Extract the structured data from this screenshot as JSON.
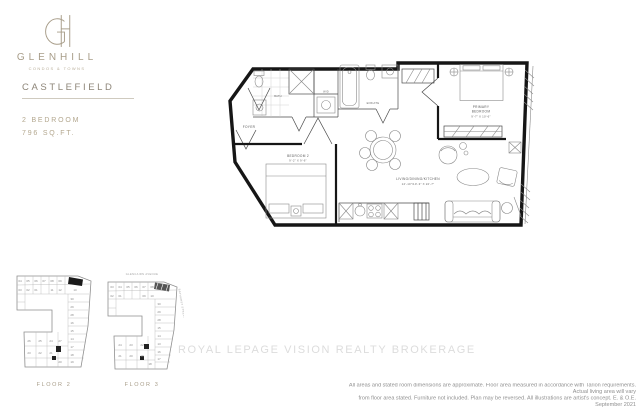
{
  "brand": {
    "monogram": "GH",
    "name": "GLENHILL",
    "tagline": "CONDOS & TOWNS"
  },
  "unit": {
    "title": "CASTLEFIELD",
    "type": "2 BEDROOM",
    "area": "796 SQ.FT."
  },
  "floorplan": {
    "rooms": {
      "foyer": "FOYER",
      "bath": "BATH",
      "wd": "W/D",
      "ensuite": "ENSUITE",
      "primary_l1": "PRIMARY",
      "primary_l2": "BEDROOM",
      "primary_dims": "9'-7\" X 10'-6\"",
      "bedroom2": "BEDROOM 2",
      "bedroom2_dims": "9'-2\" X 9'-6\"",
      "living": "LIVING/DINING/KITCHEN",
      "living_dims": "12'-10\"/10'-3\" X 22'-7\""
    }
  },
  "watermark": "ROYAL LEPAGE VISION REALTY BROKERAGE",
  "keyplans": {
    "floor2": {
      "caption": "FLOOR 2",
      "units": [
        {
          "n": "04",
          "x": 8,
          "y": 12
        },
        {
          "n": "05",
          "x": 16,
          "y": 12
        },
        {
          "n": "06",
          "x": 24,
          "y": 12
        },
        {
          "n": "07",
          "x": 32,
          "y": 12
        },
        {
          "n": "08",
          "x": 40,
          "y": 12
        },
        {
          "n": "09",
          "x": 48,
          "y": 12
        },
        {
          "n": "03",
          "x": 8,
          "y": 21
        },
        {
          "n": "02",
          "x": 16,
          "y": 21
        },
        {
          "n": "01",
          "x": 24,
          "y": 21
        },
        {
          "n": "11",
          "x": 40,
          "y": 21
        },
        {
          "n": "12",
          "x": 48,
          "y": 21
        },
        {
          "n": "10",
          "x": 63,
          "y": 21
        },
        {
          "n": "30",
          "x": 60,
          "y": 30
        },
        {
          "n": "29",
          "x": 60,
          "y": 38
        },
        {
          "n": "28",
          "x": 60,
          "y": 46
        },
        {
          "n": "16",
          "x": 60,
          "y": 54
        },
        {
          "n": "15",
          "x": 60,
          "y": 62
        },
        {
          "n": "14",
          "x": 60,
          "y": 70
        },
        {
          "n": "17",
          "x": 60,
          "y": 78
        },
        {
          "n": "18",
          "x": 60,
          "y": 86
        },
        {
          "n": "19",
          "x": 60,
          "y": 93
        },
        {
          "n": "20",
          "x": 48,
          "y": 93
        },
        {
          "n": "27",
          "x": 48,
          "y": 72
        },
        {
          "n": "26",
          "x": 17,
          "y": 72
        },
        {
          "n": "25",
          "x": 28,
          "y": 72
        },
        {
          "n": "24",
          "x": 39,
          "y": 72
        },
        {
          "n": "23",
          "x": 17,
          "y": 84
        },
        {
          "n": "22",
          "x": 28,
          "y": 84
        },
        {
          "n": "21",
          "x": 39,
          "y": 84
        }
      ]
    },
    "floor3": {
      "caption": "FLOOR 3",
      "street_top": "GLENCAIRN AVENUE",
      "street_right": "BATHURST STREET",
      "units": [
        {
          "n": "03",
          "x": 12,
          "y": 18
        },
        {
          "n": "04",
          "x": 20,
          "y": 18
        },
        {
          "n": "05",
          "x": 28,
          "y": 18
        },
        {
          "n": "06",
          "x": 36,
          "y": 18
        },
        {
          "n": "07",
          "x": 44,
          "y": 18
        },
        {
          "n": "08",
          "x": 52,
          "y": 18
        },
        {
          "n": "02",
          "x": 12,
          "y": 27
        },
        {
          "n": "01",
          "x": 20,
          "y": 27
        },
        {
          "n": "09",
          "x": 44,
          "y": 27
        },
        {
          "n": "10",
          "x": 52,
          "y": 27
        },
        {
          "n": "30",
          "x": 59,
          "y": 35
        },
        {
          "n": "29",
          "x": 59,
          "y": 43
        },
        {
          "n": "28",
          "x": 59,
          "y": 51
        },
        {
          "n": "15",
          "x": 59,
          "y": 59
        },
        {
          "n": "14",
          "x": 59,
          "y": 67
        },
        {
          "n": "13",
          "x": 59,
          "y": 75
        },
        {
          "n": "16",
          "x": 59,
          "y": 83
        },
        {
          "n": "17",
          "x": 59,
          "y": 90
        },
        {
          "n": "18",
          "x": 50,
          "y": 95
        },
        {
          "n": "24",
          "x": 20,
          "y": 76
        },
        {
          "n": "23",
          "x": 31,
          "y": 76
        },
        {
          "n": "22",
          "x": 42,
          "y": 76
        },
        {
          "n": "21",
          "x": 20,
          "y": 87
        },
        {
          "n": "20",
          "x": 31,
          "y": 87
        },
        {
          "n": "19",
          "x": 42,
          "y": 87
        }
      ]
    }
  },
  "disclaimer": {
    "line1": "All areas and stated room dimensions are approximate. Floor area measured in accordance with Tarion requirements. Actual living area will vary",
    "line2": "from floor area stated. Furniture not included. Plan may be reversed. All illustrations are artist's concept. E. & O.E. September 2021"
  }
}
